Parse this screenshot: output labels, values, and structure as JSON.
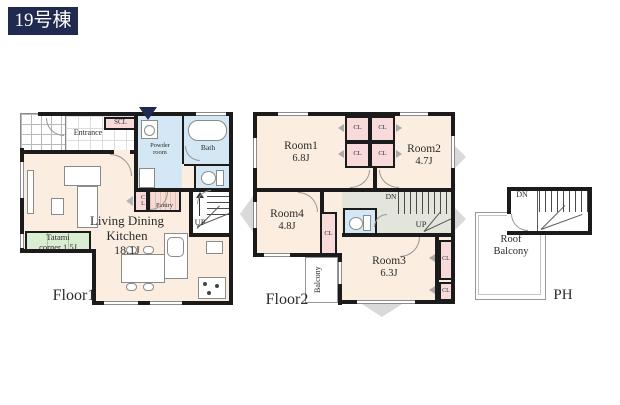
{
  "badge": {
    "label": "19号棟"
  },
  "floor1": {
    "label": "Floor1",
    "entrance": "Entrance",
    "scl": "SCL",
    "powder_line1": "Powder",
    "powder_line2": "room",
    "bath": "Bath",
    "ldk_line1": "Living Dining",
    "ldk_line2": "Kitchen",
    "ldk_size": "18.1J",
    "tatami_line1": "Tatami",
    "tatami_line2": "corner 1.5J",
    "pantry": "Pantry",
    "cl": "CL",
    "up": "UP"
  },
  "floor2": {
    "label": "Floor2",
    "room1": "Room1",
    "room1_size": "6.8J",
    "room2": "Room2",
    "room2_size": "4.7J",
    "room3": "Room3",
    "room3_size": "6.3J",
    "room4": "Room4",
    "room4_size": "4.8J",
    "cl": "CL",
    "balcony": "Balcony",
    "dn": "DN",
    "up": "UP"
  },
  "ph": {
    "label": "PH",
    "roof_line1": "Roof",
    "roof_line2": "Balcony",
    "dn": "DN"
  },
  "colors": {
    "wall": "#1b1b1b",
    "room_fill": "#fbeee1",
    "wet_fill": "#d3e8f4",
    "tatami_fill": "#daecd2",
    "closet_fill": "#f8dadb",
    "hallway_fill": "#e3e4da",
    "badge_bg": "#20294f",
    "entry_arrow": "#20294f"
  }
}
